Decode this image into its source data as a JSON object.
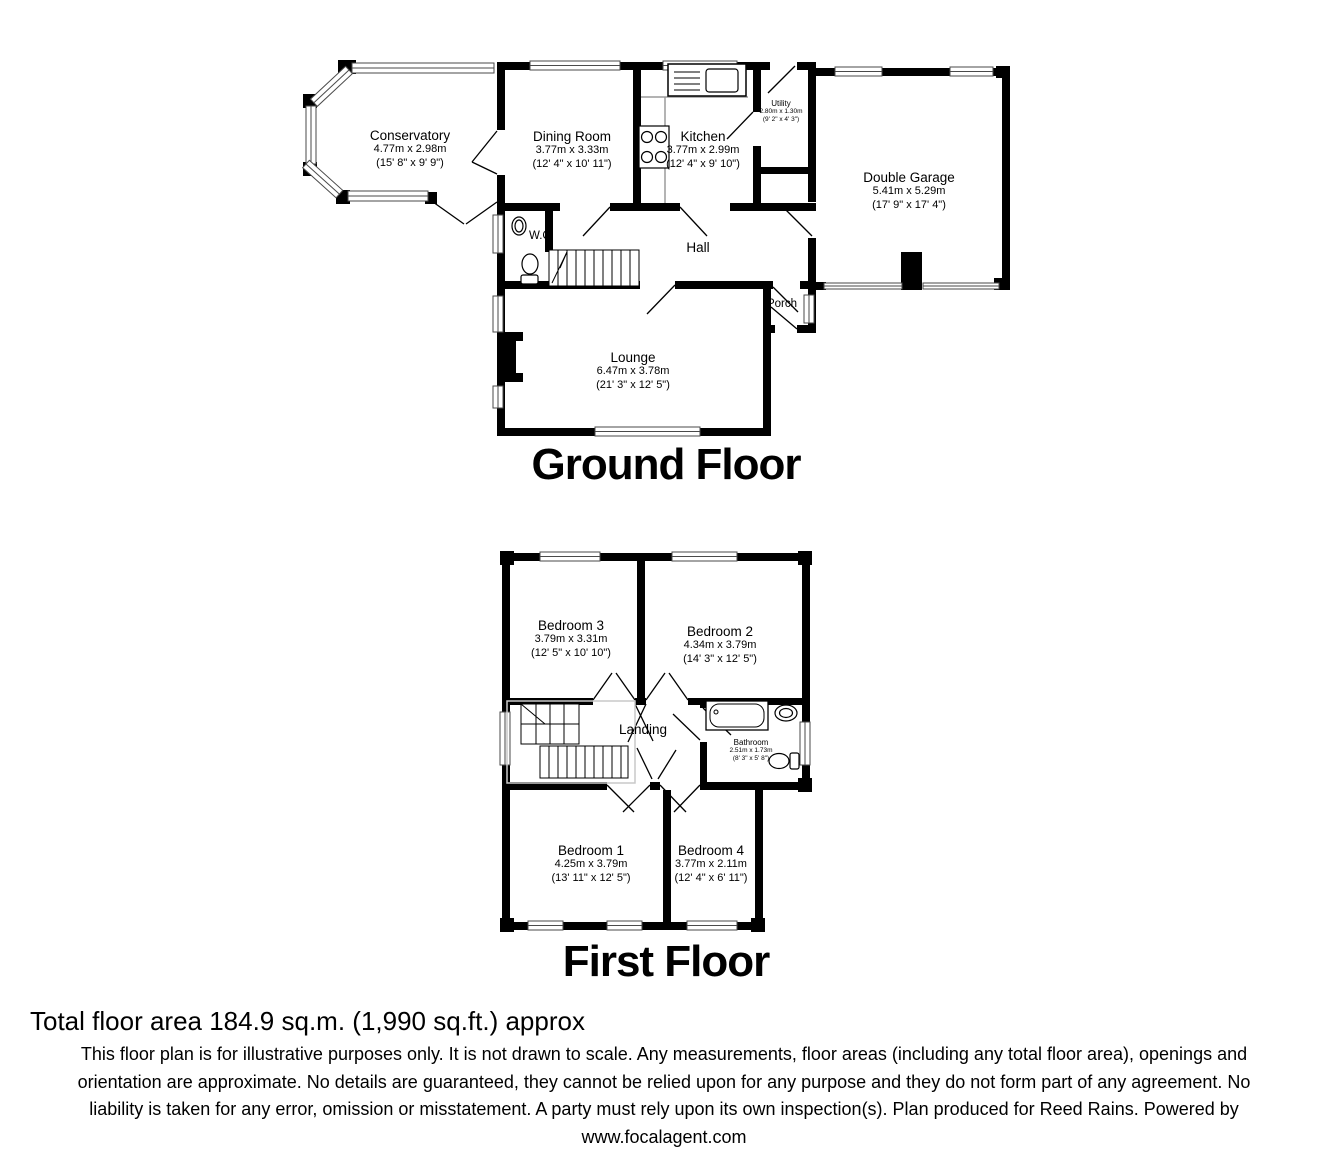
{
  "colors": {
    "walls": "#000000",
    "background": "#ffffff",
    "window_lines": "#4a4a4a"
  },
  "ground_floor": {
    "title": "Ground Floor",
    "rooms": {
      "conservatory": {
        "name": "Conservatory",
        "metric": "4.77m x 2.98m",
        "imperial": "(15' 8\" x 9' 9\")"
      },
      "dining_room": {
        "name": "Dining Room",
        "metric": "3.77m x 3.33m",
        "imperial": "(12' 4\" x 10' 11\")"
      },
      "kitchen": {
        "name": "Kitchen",
        "metric": "3.77m x 2.99m",
        "imperial": "(12' 4\" x 9' 10\")"
      },
      "utility": {
        "name": "Utility",
        "metric": "2.80m x 1.30m",
        "imperial": "(9' 2\" x 4' 3\")"
      },
      "double_garage": {
        "name": "Double Garage",
        "metric": "5.41m x 5.29m",
        "imperial": "(17' 9\" x 17' 4\")"
      },
      "hall": {
        "name": "Hall"
      },
      "wc": {
        "name": "W.C."
      },
      "porch": {
        "name": "Porch"
      },
      "lounge": {
        "name": "Lounge",
        "metric": "6.47m x 3.78m",
        "imperial": "(21' 3\" x 12' 5\")"
      }
    }
  },
  "first_floor": {
    "title": "First Floor",
    "rooms": {
      "bedroom3": {
        "name": "Bedroom 3",
        "metric": "3.79m x 3.31m",
        "imperial": "(12' 5\" x 10' 10\")"
      },
      "bedroom2": {
        "name": "Bedroom 2",
        "metric": "4.34m x 3.79m",
        "imperial": "(14' 3\" x 12' 5\")"
      },
      "landing": {
        "name": "Landing"
      },
      "bathroom": {
        "name": "Bathroom",
        "metric": "2.51m x 1.73m",
        "imperial": "(8' 3\" x 5' 8\")"
      },
      "bedroom1": {
        "name": "Bedroom 1",
        "metric": "4.25m x 3.79m",
        "imperial": "(13' 11\" x 12' 5\")"
      },
      "bedroom4": {
        "name": "Bedroom 4",
        "metric": "3.77m x 2.11m",
        "imperial": "(12' 4\" x 6' 11\")"
      }
    }
  },
  "icons": [
    "staircase-icon",
    "toilet-icon",
    "basin-icon",
    "bath-icon",
    "kitchen-sink-icon",
    "hob-icon",
    "fireplace-icon",
    "window-marker",
    "door-swing"
  ],
  "footer": {
    "total_area": "Total floor area 184.9 sq.m. (1,990 sq.ft.) approx",
    "disclaimer_line1": "This floor plan is for illustrative purposes only. It is not drawn to scale. Any measurements, floor areas (including any total floor area), openings and",
    "disclaimer_line2": "orientation are approximate. No details are guaranteed, they cannot be relied upon for any purpose and they do not form part of any agreement. No",
    "disclaimer_line3": "liability is taken for any error, omission or misstatement. A party must rely upon its own inspection(s). Plan produced for Reed Rains. Powered by",
    "disclaimer_line4": "www.focalagent.com"
  }
}
